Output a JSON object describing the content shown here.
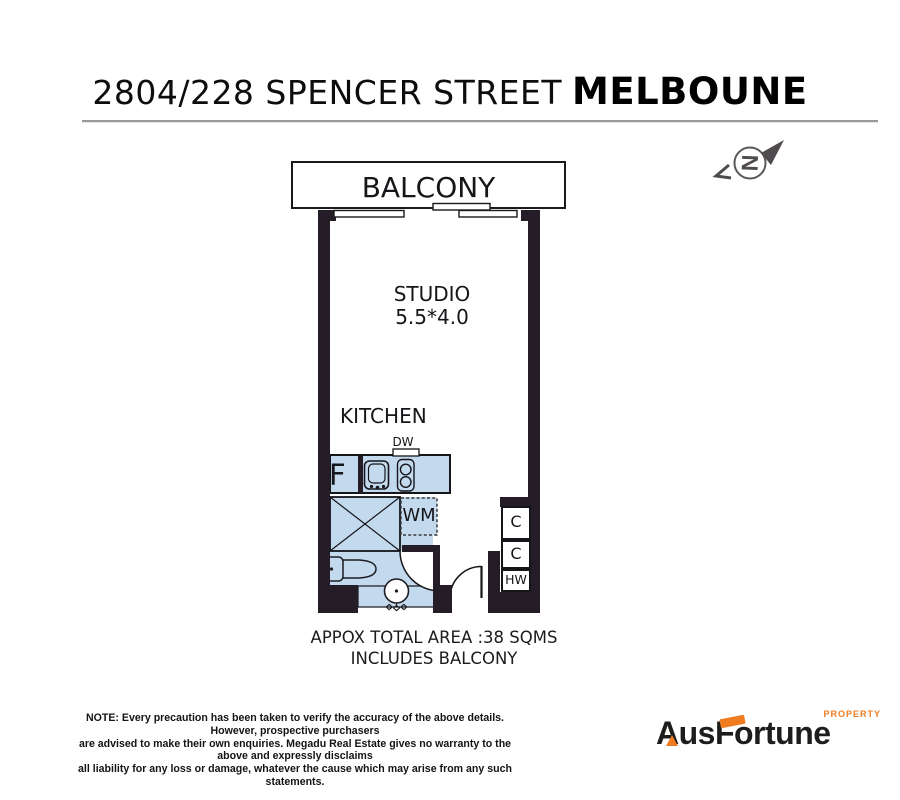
{
  "page_title": {
    "address": "2804/228 SPENCER STREET",
    "city": "MELBOUNE"
  },
  "compass": {
    "north_letter": "N"
  },
  "plan_labels": {
    "balcony": "BALCONY",
    "studio": "STUDIO",
    "studio_dimensions": "5.5*4.0",
    "kitchen": "KITCHEN",
    "dishwasher": "DW",
    "fridge": "F",
    "washing_machine": "WM",
    "cupboard_top": "C",
    "cupboard_bottom": "C",
    "hot_water": "HW"
  },
  "area_summary": {
    "line1": "APPOX TOTAL AREA :38 SQMS",
    "line2": "INCLUDES BALCONY"
  },
  "disclaimer": {
    "line1": "NOTE: Every precaution has been taken to verify the accuracy of the above details. However, prospective purchasers",
    "line2": "are advised to make their own enquiries. Megadu Real Estate gives no warranty to the above and expressly disclaims",
    "line3": "all liability for any loss or damage, whatever the cause which may arise from any such statements."
  },
  "logo": {
    "name_prefix": "Aus",
    "name_middle": "F",
    "name_suffix": "ortune",
    "tagline": "PROPERTY"
  },
  "colors": {
    "wall": "#241c26",
    "floor_blue": "#c3daee",
    "outline": "#15151a",
    "accent_orange": "#f07c21",
    "logo_dark": "#1d1d1b",
    "compass_gray": "#4e4a4e",
    "divider_gray": "#9a9a9a"
  }
}
